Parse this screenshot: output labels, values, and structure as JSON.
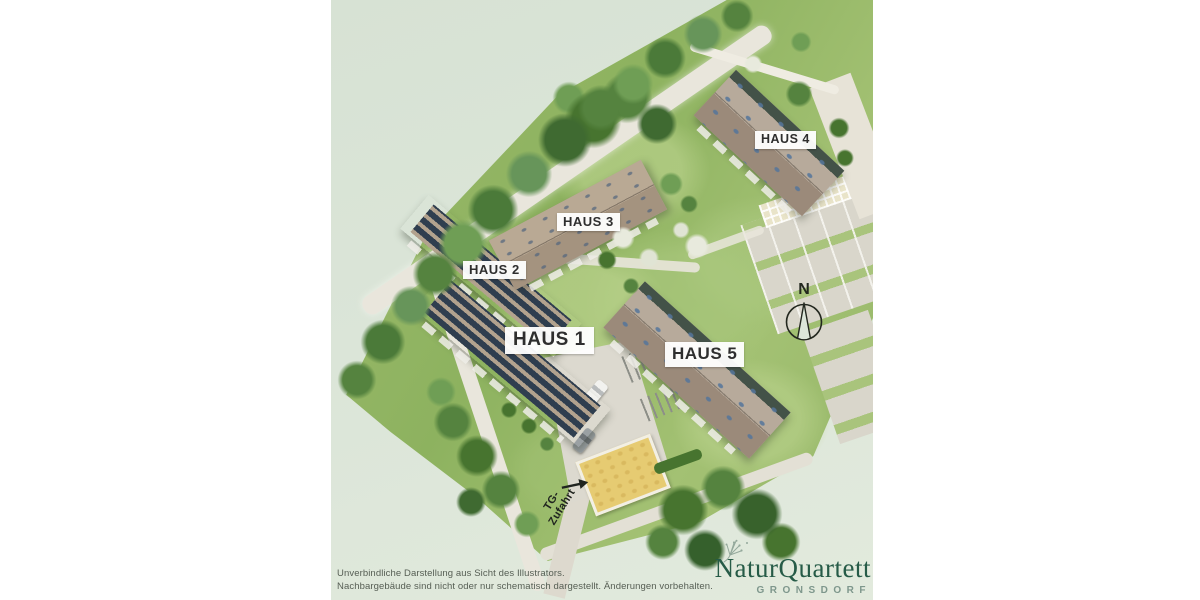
{
  "site_plan": {
    "buildings": [
      {
        "id": "haus-1",
        "label": "HAUS 1"
      },
      {
        "id": "haus-2",
        "label": "HAUS 2"
      },
      {
        "id": "haus-3",
        "label": "HAUS 3"
      },
      {
        "id": "haus-4",
        "label": "HAUS 4"
      },
      {
        "id": "haus-5",
        "label": "HAUS 5"
      }
    ],
    "compass": {
      "label": "N"
    },
    "garage_access": {
      "line1": "TG-",
      "line2": "Zufahrt"
    }
  },
  "footer": {
    "disclaimer_line1": "Unverbindliche Darstellung aus Sicht des Illustrators.",
    "disclaimer_line2": "Nachbargebäude sind nicht oder nur schematisch dargestellt. Änderungen vorbehalten."
  },
  "brand": {
    "name": "NaturQuartett",
    "location": "GRONSDORF"
  },
  "colors": {
    "background_sage": "#dbe5d8",
    "lawn_green": "#8fb362",
    "roof_tan": "#b2a28e",
    "solar_dark": "#2f3e4f",
    "label_text": "#2e2e2e",
    "logo_green": "#265b47",
    "location_green": "#7e978c"
  }
}
